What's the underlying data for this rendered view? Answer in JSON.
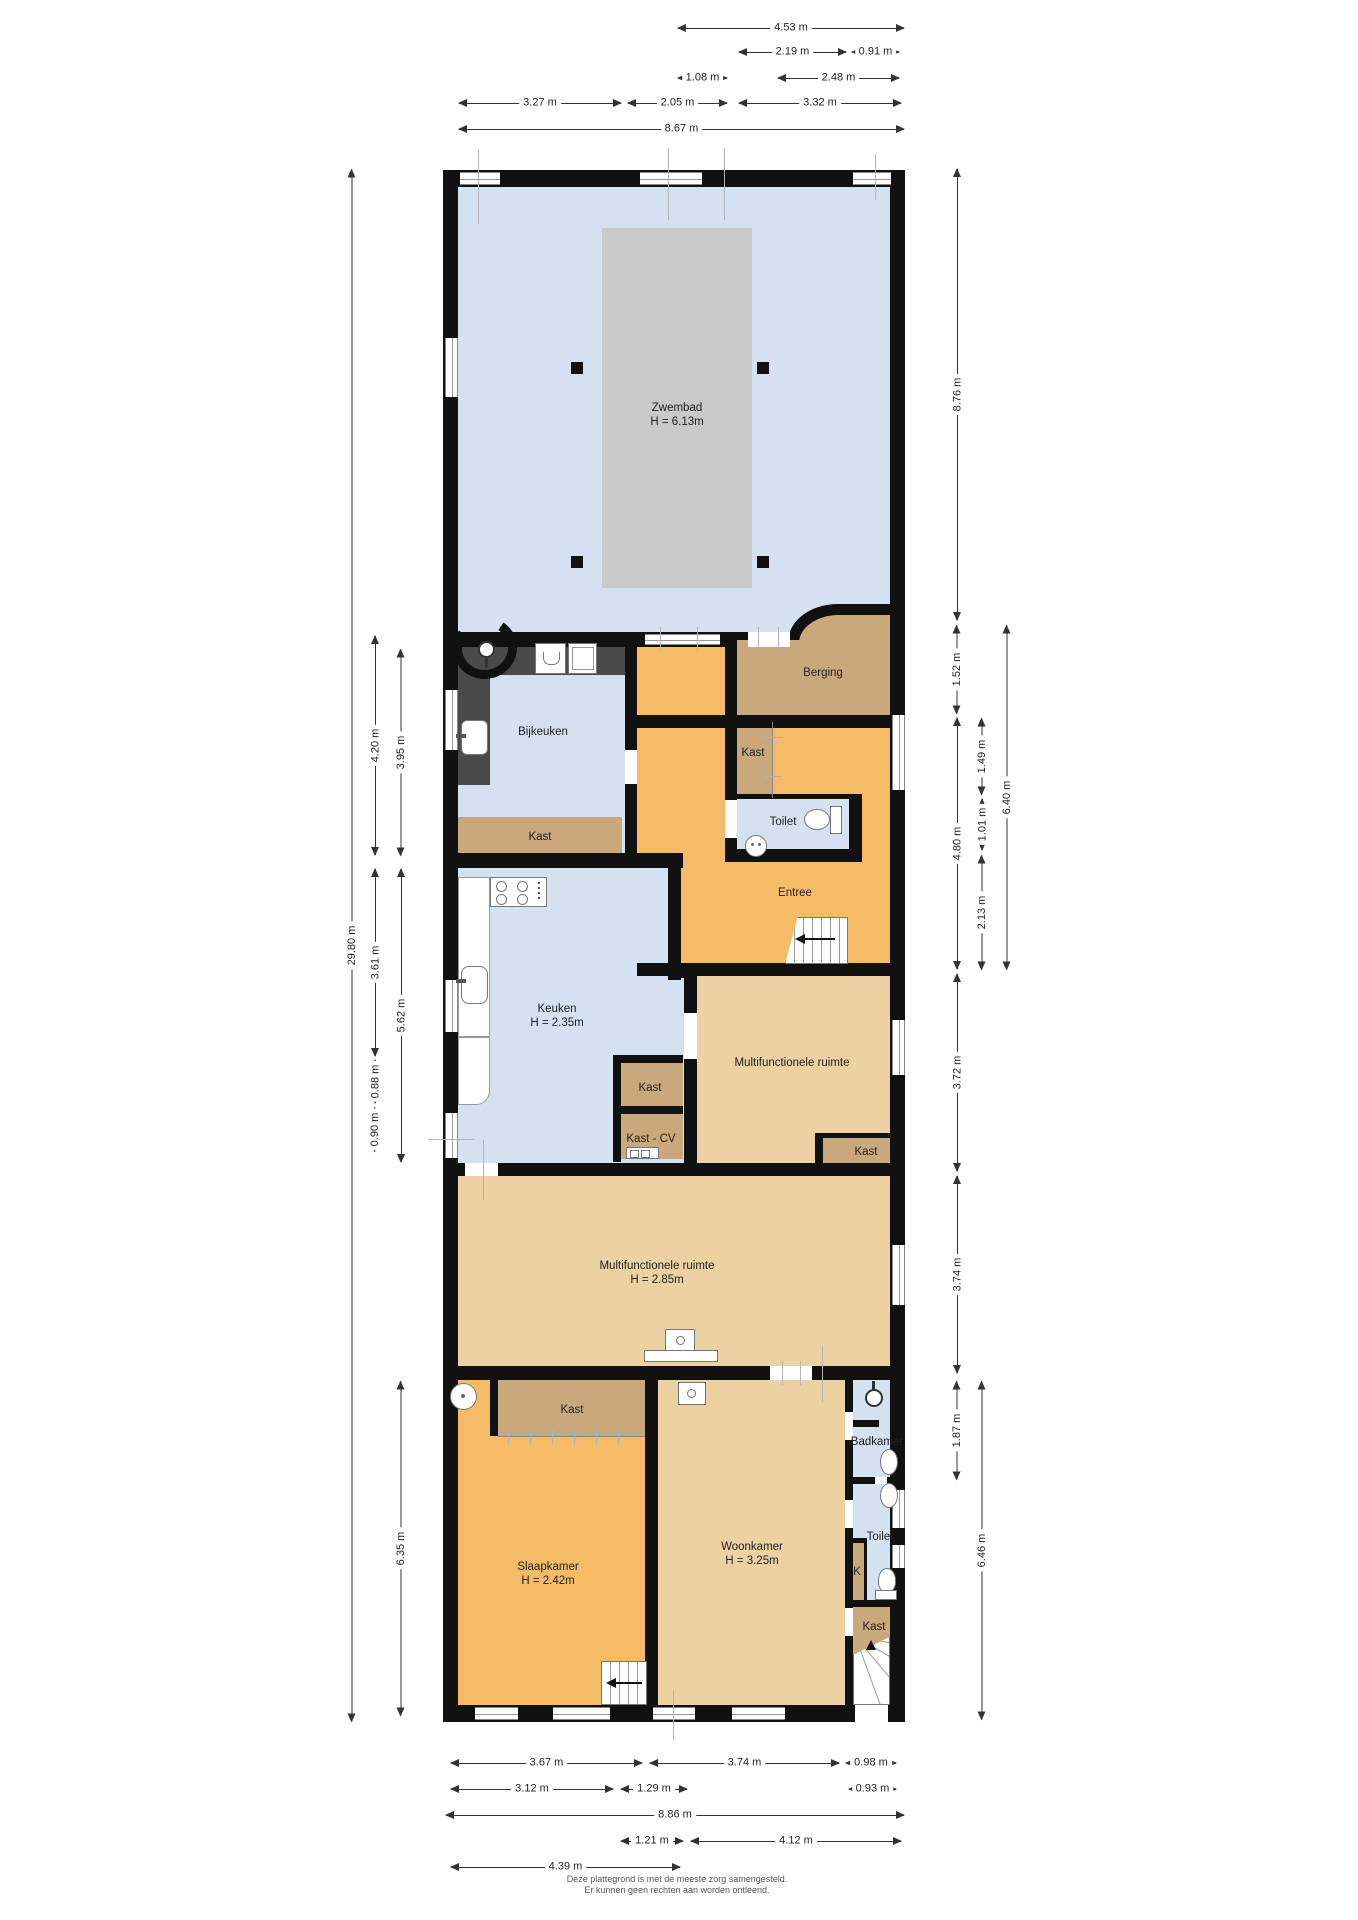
{
  "document": {
    "type": "floor-plan",
    "footer_line1": "Deze plattegrond is met de meeste zorg samengesteld.",
    "footer_line2": "Er kunnen geen rechten aan worden ontleend."
  },
  "colors": {
    "wall": "#111111",
    "floor_blue": "#d3e1f1",
    "floor_orange": "#f6bb67",
    "floor_tan": "#c9a97b",
    "floor_light_tan": "#ecd2a2",
    "pool": "#c9c9c9",
    "counter": "#4a4a4a"
  },
  "rooms": [
    {
      "id": "zwembad",
      "label": "Zwembad",
      "height": "H = 6.13m",
      "x": 677,
      "y": 415
    },
    {
      "id": "berging",
      "label": "Berging",
      "x": 823,
      "y": 673
    },
    {
      "id": "kast-entree",
      "label": "Kast",
      "x": 753,
      "y": 753
    },
    {
      "id": "toilet-entree",
      "label": "Toilet",
      "x": 783,
      "y": 822
    },
    {
      "id": "entree",
      "label": "Entree",
      "x": 795,
      "y": 893
    },
    {
      "id": "bijkeuken",
      "label": "Bijkeuken",
      "x": 543,
      "y": 732
    },
    {
      "id": "kast-bijkeuken",
      "label": "Kast",
      "x": 540,
      "y": 837
    },
    {
      "id": "keuken",
      "label": "Keuken",
      "height": "H = 2.35m",
      "x": 557,
      "y": 1016
    },
    {
      "id": "kast-keuken",
      "label": "Kast",
      "x": 650,
      "y": 1088
    },
    {
      "id": "kast-cv",
      "label": "Kast - CV",
      "x": 651,
      "y": 1139
    },
    {
      "id": "multifunctionele-ruimte-boven",
      "label": "Multifunctionele ruimte",
      "x": 792,
      "y": 1063
    },
    {
      "id": "kast-multifunctioneel",
      "label": "Kast",
      "x": 866,
      "y": 1152
    },
    {
      "id": "multifunctionele-ruimte",
      "label": "Multifunctionele ruimte",
      "height": "H = 2.85m",
      "x": 657,
      "y": 1273
    },
    {
      "id": "kast-slaapkamer",
      "label": "Kast",
      "x": 572,
      "y": 1410
    },
    {
      "id": "slaapkamer",
      "label": "Slaapkamer",
      "height": "H = 2.42m",
      "x": 548,
      "y": 1574
    },
    {
      "id": "woonkamer",
      "label": "Woonkamer",
      "height": "H = 3.25m",
      "x": 752,
      "y": 1554
    },
    {
      "id": "badkamer",
      "label": "Badkamer",
      "x": 877,
      "y": 1442
    },
    {
      "id": "toilet",
      "label": "Toilet",
      "x": 880,
      "y": 1537
    },
    {
      "id": "k",
      "label": "K",
      "x": 857,
      "y": 1572
    },
    {
      "id": "kast-trap",
      "label": "Kast",
      "x": 874,
      "y": 1627
    }
  ],
  "dimensions": {
    "horizontal": [
      {
        "label": "4.53 m",
        "x1": 677,
        "x2": 905,
        "y": 28
      },
      {
        "label": "2.19 m",
        "x1": 738,
        "x2": 847,
        "y": 52
      },
      {
        "label": "0.91 m",
        "x1": 851,
        "x2": 900,
        "y": 52
      },
      {
        "label": "1.08 m",
        "x1": 677,
        "x2": 728,
        "y": 78
      },
      {
        "label": "2.48 m",
        "x1": 777,
        "x2": 900,
        "y": 78
      },
      {
        "label": "3.27 m",
        "x1": 458,
        "x2": 622,
        "y": 103
      },
      {
        "label": "2.05 m",
        "x1": 627,
        "x2": 728,
        "y": 103
      },
      {
        "label": "3.32 m",
        "x1": 738,
        "x2": 902,
        "y": 103
      },
      {
        "label": "8.67 m",
        "x1": 458,
        "x2": 905,
        "y": 129
      },
      {
        "label": "3.67 m",
        "x1": 450,
        "x2": 643,
        "y": 1763
      },
      {
        "label": "3.74 m",
        "x1": 649,
        "x2": 840,
        "y": 1763
      },
      {
        "label": "0.98 m",
        "x1": 845,
        "x2": 897,
        "y": 1763
      },
      {
        "label": "3.12 m",
        "x1": 450,
        "x2": 614,
        "y": 1789
      },
      {
        "label": "1.29 m",
        "x1": 620,
        "x2": 688,
        "y": 1789
      },
      {
        "label": "0.93 m",
        "x1": 848,
        "x2": 897,
        "y": 1789
      },
      {
        "label": "8.86 m",
        "x1": 445,
        "x2": 905,
        "y": 1815
      },
      {
        "label": "1.21 m",
        "x1": 620,
        "x2": 684,
        "y": 1841
      },
      {
        "label": "4.12 m",
        "x1": 690,
        "x2": 902,
        "y": 1841
      },
      {
        "label": "4.39 m",
        "x1": 450,
        "x2": 681,
        "y": 1867
      }
    ],
    "vertical": [
      {
        "label": "29.80 m",
        "y1": 168,
        "y2": 1722,
        "x": 352
      },
      {
        "label": "4.20 m",
        "y1": 635,
        "y2": 856,
        "x": 375
      },
      {
        "label": "3.95 m",
        "y1": 648,
        "y2": 856,
        "x": 401
      },
      {
        "label": "3.61 m",
        "y1": 868,
        "y2": 1057,
        "x": 375
      },
      {
        "label": "5.62 m",
        "y1": 868,
        "y2": 1163,
        "x": 401
      },
      {
        "label": "0.88 m",
        "y1": 1059,
        "y2": 1104,
        "x": 375
      },
      {
        "label": "0.90 m",
        "y1": 1106,
        "y2": 1152,
        "x": 375
      },
      {
        "label": "6.35 m",
        "y1": 1380,
        "y2": 1716,
        "x": 401
      },
      {
        "label": "8.76 m",
        "y1": 168,
        "y2": 621,
        "x": 957
      },
      {
        "label": "1.52 m",
        "y1": 624,
        "y2": 714,
        "x": 957
      },
      {
        "label": "4.80 m",
        "y1": 717,
        "y2": 970,
        "x": 957
      },
      {
        "label": "1.49 m",
        "y1": 717,
        "y2": 795,
        "x": 982
      },
      {
        "label": "1.01 m",
        "y1": 798,
        "y2": 851,
        "x": 982
      },
      {
        "label": "2.13 m",
        "y1": 854,
        "y2": 970,
        "x": 982
      },
      {
        "label": "6.40 m",
        "y1": 624,
        "y2": 970,
        "x": 1007
      },
      {
        "label": "3.72 m",
        "y1": 973,
        "y2": 1172,
        "x": 957
      },
      {
        "label": "3.74 m",
        "y1": 1175,
        "y2": 1374,
        "x": 957
      },
      {
        "label": "1.87 m",
        "y1": 1380,
        "y2": 1480,
        "x": 957
      },
      {
        "label": "6.46 m",
        "y1": 1380,
        "y2": 1720,
        "x": 982
      }
    ]
  }
}
